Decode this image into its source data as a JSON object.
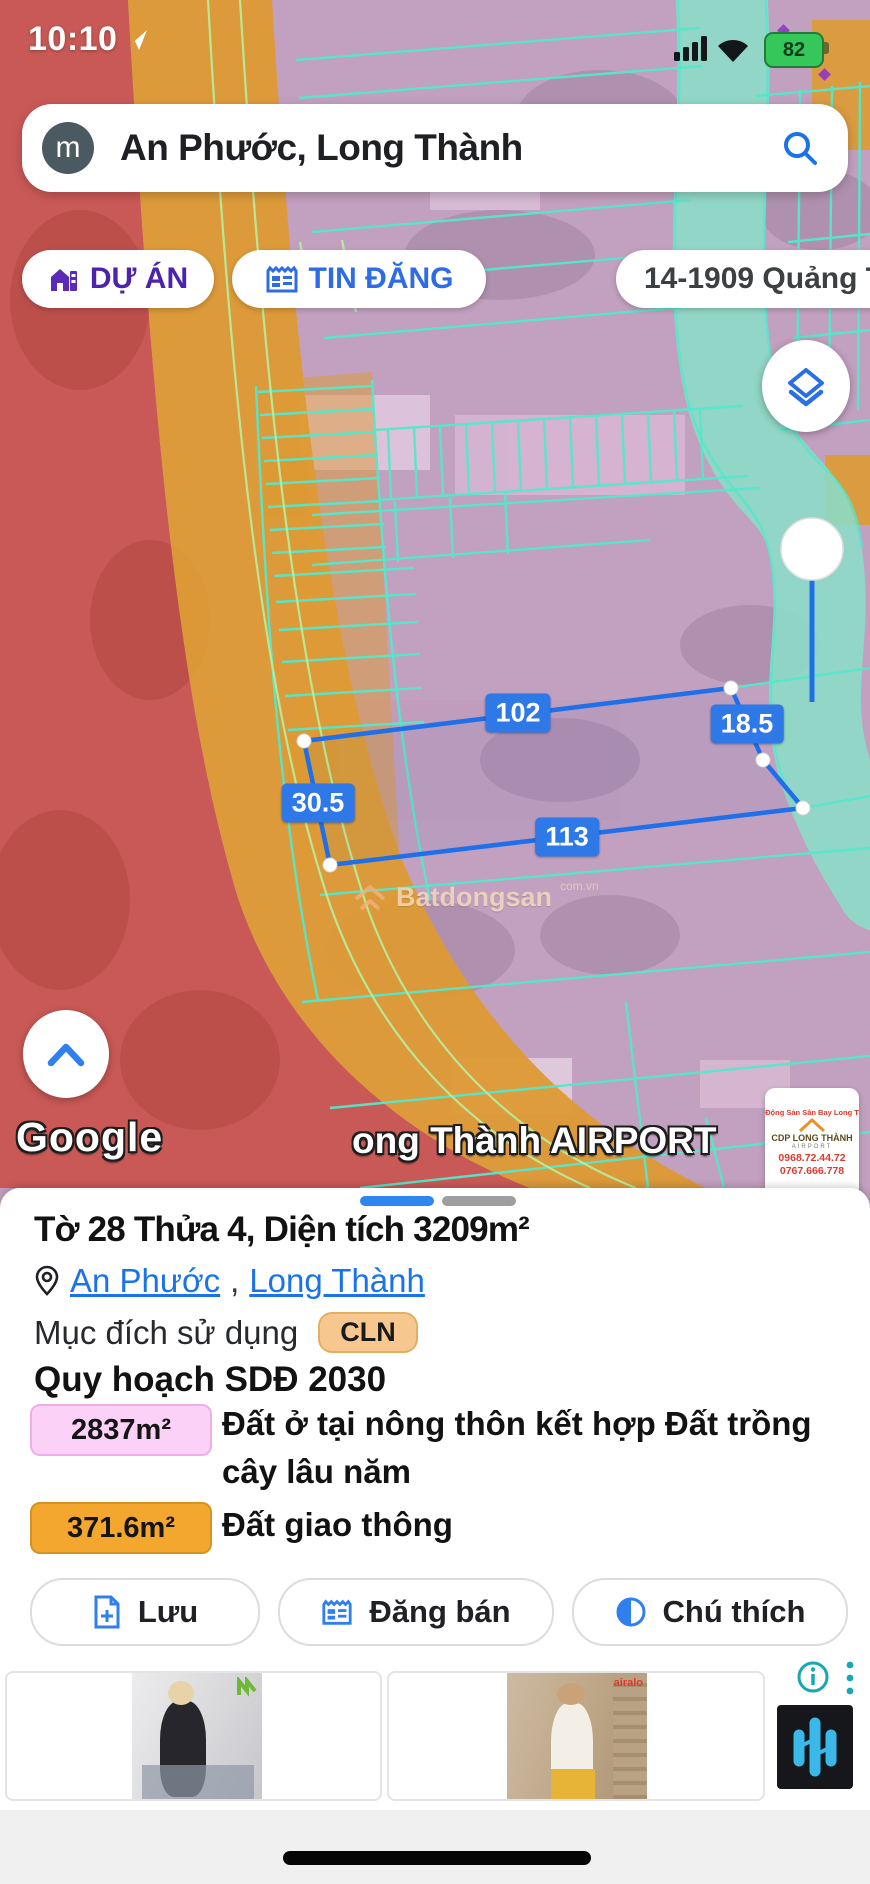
{
  "status_bar": {
    "time": "10:10",
    "battery_percent": "82"
  },
  "search": {
    "avatar_letter": "m",
    "query": "An Phước, Long Thành"
  },
  "chips": {
    "du_an": "DỰ ÁN",
    "tin_dang": "TIN ĐĂNG",
    "listing": "14-1909 Quảng Tiến"
  },
  "map": {
    "measurements": {
      "top": "102",
      "right": "18.5",
      "left": "30.5",
      "bottom": "113"
    },
    "watermark": {
      "name": "Batdongsan",
      "suffix": "com.vn"
    },
    "attribution": "Google",
    "airport_label": "ong Thành AIRPORT",
    "ad_card": {
      "line1": "Động Sản Sân Bay Long T",
      "brand": "CDP LONG THÀNH",
      "sub": "AIRPORT",
      "phone1": "0968.72.44.72",
      "phone2": "0767.666.778"
    },
    "colors": {
      "zone_red": "#c9544e",
      "zone_orange": "#dd9a33",
      "zone_pink": "#c2a0bf",
      "zone_road_teal": "#8cdcc7",
      "cadastral_line": "#55e8cb",
      "parcel_outline_blue": "#1e6fe8"
    }
  },
  "panel": {
    "title": "Tờ 28 Thửa 4, Diện tích 3209m²",
    "location": {
      "part1": "An Phước",
      "separator": ",",
      "part2": "Long Thành"
    },
    "land_use_label": "Mục đích sử dụng",
    "land_use_code": "CLN",
    "planning_title": "Quy hoạch SDĐ 2030",
    "legend": [
      {
        "area": "2837m²",
        "label": "Đất ở tại nông thôn kết hợp Đất trồng cây lâu năm",
        "color": "#fbd1f7"
      },
      {
        "area": "371.6m²",
        "label": "Đất giao thông",
        "color": "#f3a72f"
      }
    ],
    "actions": [
      {
        "label": "Lưu"
      },
      {
        "label": "Đăng bán"
      },
      {
        "label": "Chú thích"
      }
    ]
  },
  "ads": {
    "card2_brand": "airalo"
  }
}
